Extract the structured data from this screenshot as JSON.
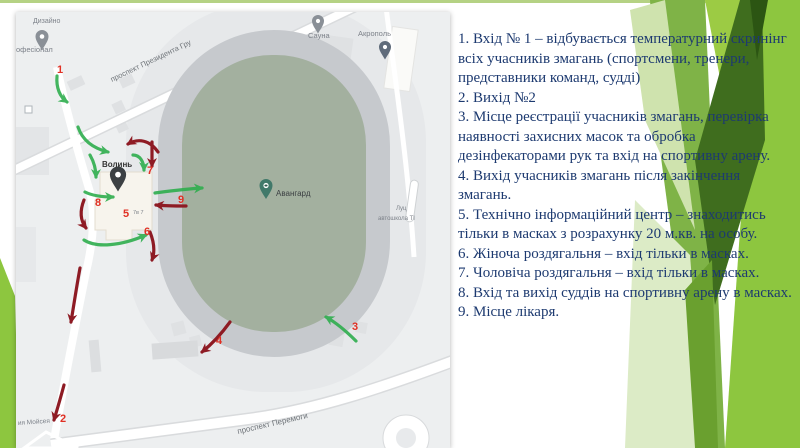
{
  "slide": {
    "accent_green": "#8dc63f",
    "top_line_color": "#b5d284"
  },
  "map": {
    "arrow_green": "#2fae4e",
    "arrow_red": "#8e1b24",
    "marker_color": "#e03024",
    "labels": {
      "dyzaino": "Дизайно",
      "profesional": "офесіонал",
      "prospekt_prezydenta": "проспект Президента Гру",
      "sauna": "Сауна",
      "akropol": "Акрополь",
      "volyn": "Волинь",
      "avanhard": "Авангард",
      "luts": "Луц",
      "avtoshkola": "автошкола ТІ",
      "bldg_small": "7в 7",
      "prospekt_peremohy": "проспект Перемоги",
      "moiseia": "ия Мойсея"
    },
    "markers": [
      {
        "label": "1"
      },
      {
        "label": "2"
      },
      {
        "label": "3"
      },
      {
        "label": "4"
      },
      {
        "label": "5"
      },
      {
        "label": "6"
      },
      {
        "label": "7"
      },
      {
        "label": "8"
      },
      {
        "label": "9"
      }
    ]
  },
  "panel": {
    "text_color": "#1d3a70",
    "items": [
      "1. Вхід  № 1 – відбувається температурний скринінг всіх учасників змагань (спортсмени, тренери, представники команд, судді)",
      "2. Вихід №2",
      "3. Місце реєстрації учасників змагань, перевірка наявності захисних масок та обробка дезінфекаторами рук та вхід на спортивну арену.",
      "4. Вихід учасників змагань після закінчення змагань.",
      "5. Технічно інформаційний центр – знаходитись тільки в масках з розрахунку  20 м.кв. на особу.",
      "6. Жіноча роздягальня – вхід тільки в масках.",
      "7. Чоловіча роздягальня – вхід тільки в масках.",
      "8. Вхід та вихід суддів на спортивну арену в масках.",
      "9. Місце лікаря."
    ]
  }
}
